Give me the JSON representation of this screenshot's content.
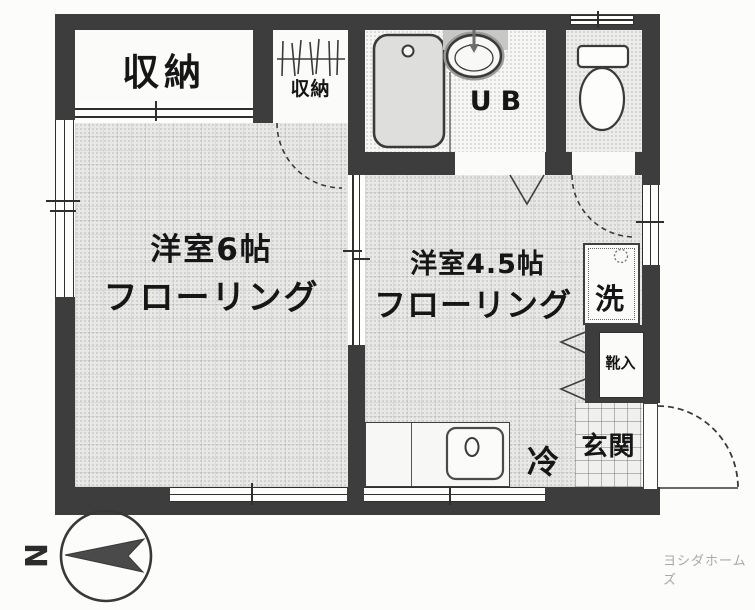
{
  "plan": {
    "closet_large": "収納",
    "closet_small": "収納",
    "unit_bath": "UB",
    "room_left_name": "洋室6帖",
    "room_left_floor": "フローリング",
    "room_right_name": "洋室4.5帖",
    "room_right_floor": "フローリング",
    "washer": "洗",
    "shoe_cabinet": "靴入",
    "refrigerator": "冷",
    "entrance": "玄関"
  },
  "compass": {
    "north": "N"
  },
  "credit": "ヨシダホームズ",
  "colors": {
    "wall": "#3d3d3d",
    "floor": "#e8e8e6",
    "ink": "#161616",
    "credit_gray": "#a9a9a7"
  }
}
